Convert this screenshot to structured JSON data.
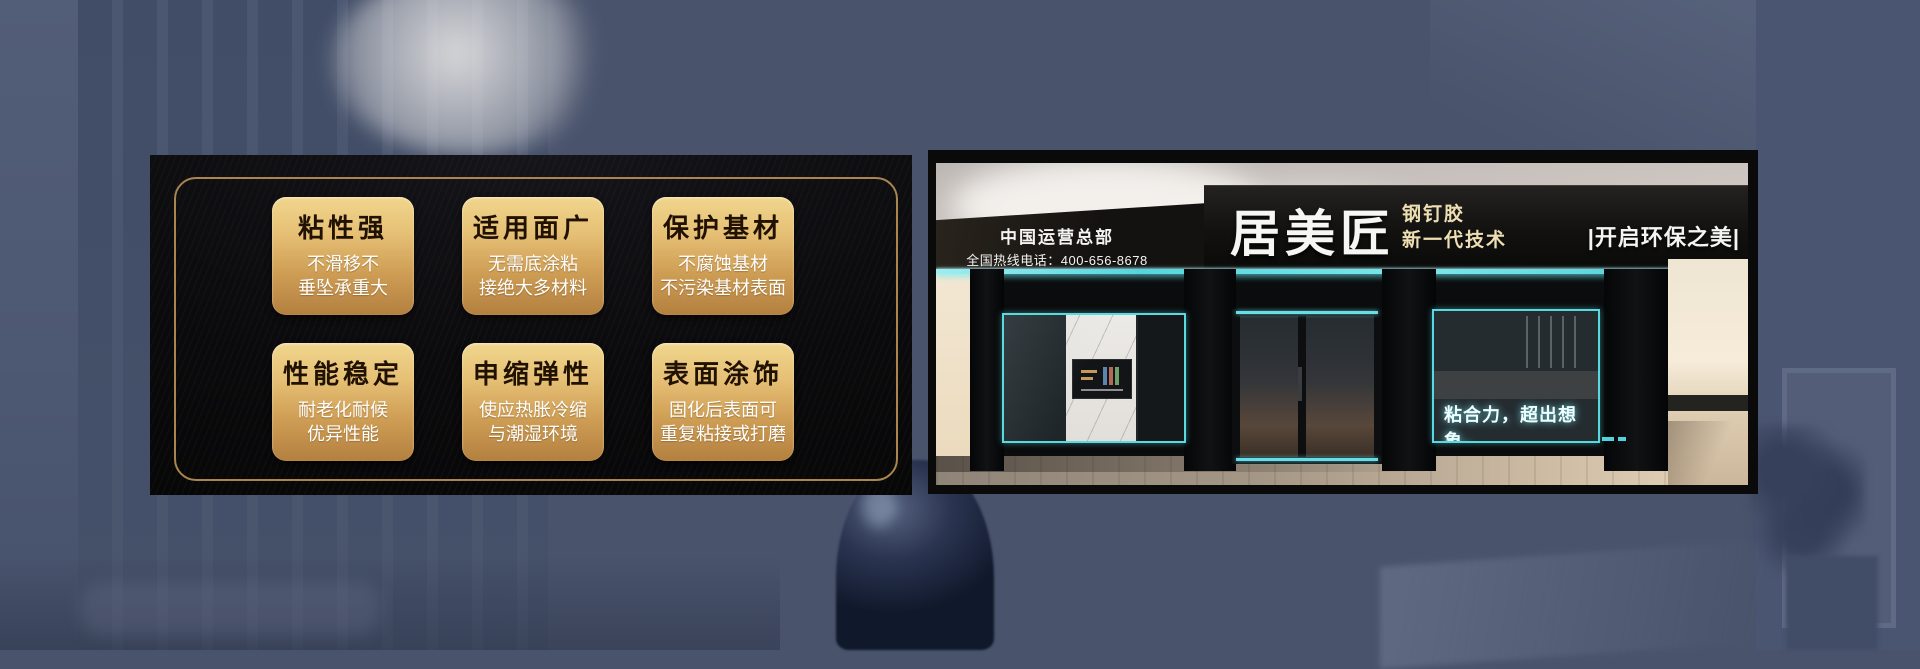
{
  "features": {
    "cards": [
      {
        "title": "粘性强",
        "line1": "不滑移不",
        "line2": "垂坠承重大"
      },
      {
        "title": "适用面广",
        "line1": "无需底涂粘",
        "line2": "接绝大多材料"
      },
      {
        "title": "保护基材",
        "line1": "不腐蚀基材",
        "line2": "不污染基材表面"
      },
      {
        "title": "性能稳定",
        "line1": "耐老化耐候",
        "line2": "优异性能"
      },
      {
        "title": "申缩弹性",
        "line1": "使应热胀冷缩",
        "line2": "与潮湿环境"
      },
      {
        "title": "表面涂饰",
        "line1": "固化后表面可",
        "line2": "重复粘接或打磨"
      }
    ]
  },
  "store_sign": {
    "hq_line1": "中国运营总部",
    "hq_line2": "全国热线电话：400-656-8678",
    "brand": "居美匠",
    "product_line1": "钢钉胶",
    "product_line2": "新一代技术",
    "right_slogan": "|开启环保之美|",
    "window_slogan": "粘合力，超出想象。"
  },
  "colors": {
    "background": "#49536c",
    "panel_black": "#0b0b0d",
    "gold_border": "#a9854f",
    "card_gold_top": "#f1d68e",
    "card_gold_bottom": "#b3803f",
    "card_title_text": "#201100",
    "card_body_text": "#ffffff",
    "led_cyan": "#54d6df",
    "sign_text_white": "#f6f6f4",
    "sign_text_beige": "#eedfb2"
  }
}
